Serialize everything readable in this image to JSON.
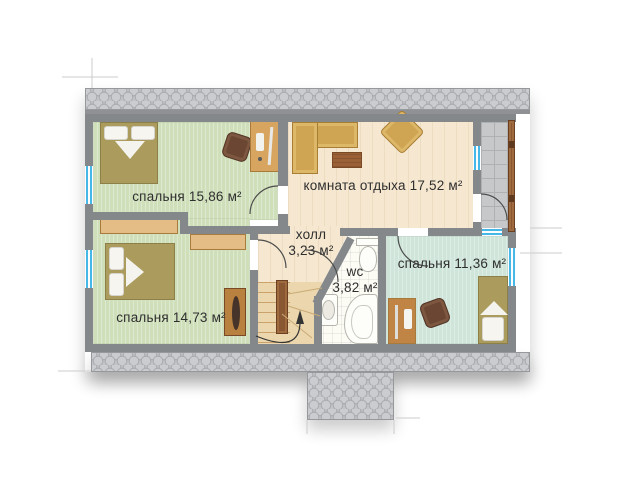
{
  "rooms": {
    "bedroom_top": {
      "name": "спальня",
      "area": "15,86 м²"
    },
    "lounge": {
      "name": "комната отдыха",
      "area": "17,52 м²"
    },
    "hall": {
      "name": "холл",
      "area": "3,23 м²"
    },
    "wc": {
      "name": "wc",
      "area": "3,82 м²"
    },
    "bedroom_right": {
      "name": "спальня",
      "area": "11,36 м²"
    },
    "bedroom_bottom": {
      "name": "спальня",
      "area": "14,73 м²"
    }
  },
  "colors": {
    "wall": "#85888b",
    "roof": "#c2c4c7",
    "floor_green": "#cfdfba",
    "floor_cream": "#f6e8d0",
    "floor_mint": "#cfe5da",
    "wc_tile": "#fcfbf4",
    "stone": "#c6c8ca",
    "window_glass": "#45b8e8",
    "wood": "#d7a55f",
    "wood_dark": "#9c6036"
  },
  "furniture": {
    "bedroom_top": [
      "double-bed",
      "office-chair",
      "desk-with-computer"
    ],
    "lounge": [
      "corner-sofa",
      "coffee-table",
      "armchair"
    ],
    "bedroom_bottom": [
      "double-bed",
      "wardrobe",
      "wardrobe",
      "desk-with-monitor"
    ],
    "bedroom_right": [
      "single-bed",
      "office-chair",
      "desk-with-computer"
    ],
    "wc": [
      "toilet",
      "sink",
      "corner-bathtub"
    ],
    "circulation": [
      "winder-staircase",
      "balcony-railing"
    ]
  }
}
